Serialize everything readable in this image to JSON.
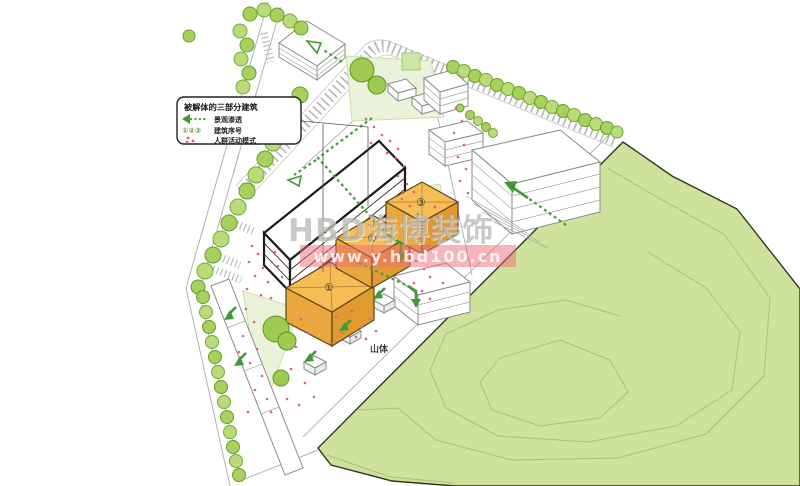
{
  "legend": {
    "title": "被解体的三部分建筑",
    "items": [
      {
        "icon": "green-dashed-arrow",
        "label": "景观渗透"
      },
      {
        "icon": "circled-numbers",
        "symbol": "①②③",
        "label": "建筑序号"
      },
      {
        "icon": "red-activity-dots",
        "label": "人群活动模式"
      }
    ]
  },
  "buildings": {
    "one": "①",
    "two": "②",
    "three": "③"
  },
  "labels": {
    "mountain": "山体"
  },
  "watermark": {
    "brand": "HBD海博装饰",
    "url": "www.y.hbd100.cn"
  },
  "palette": {
    "highlight_building_top": "#f6bd57",
    "highlight_building_side": "#e8a238",
    "hill_fill": "#cfe29c",
    "hill_contour": "#a8c373",
    "tree_fill": "#a8d05c",
    "tree_stroke": "#649d2b",
    "arrow_green": "#3d9a36",
    "activity_dot": "#e0607a",
    "watermark_band": "#ee6c76",
    "watermark_text": "#9e9a94"
  }
}
